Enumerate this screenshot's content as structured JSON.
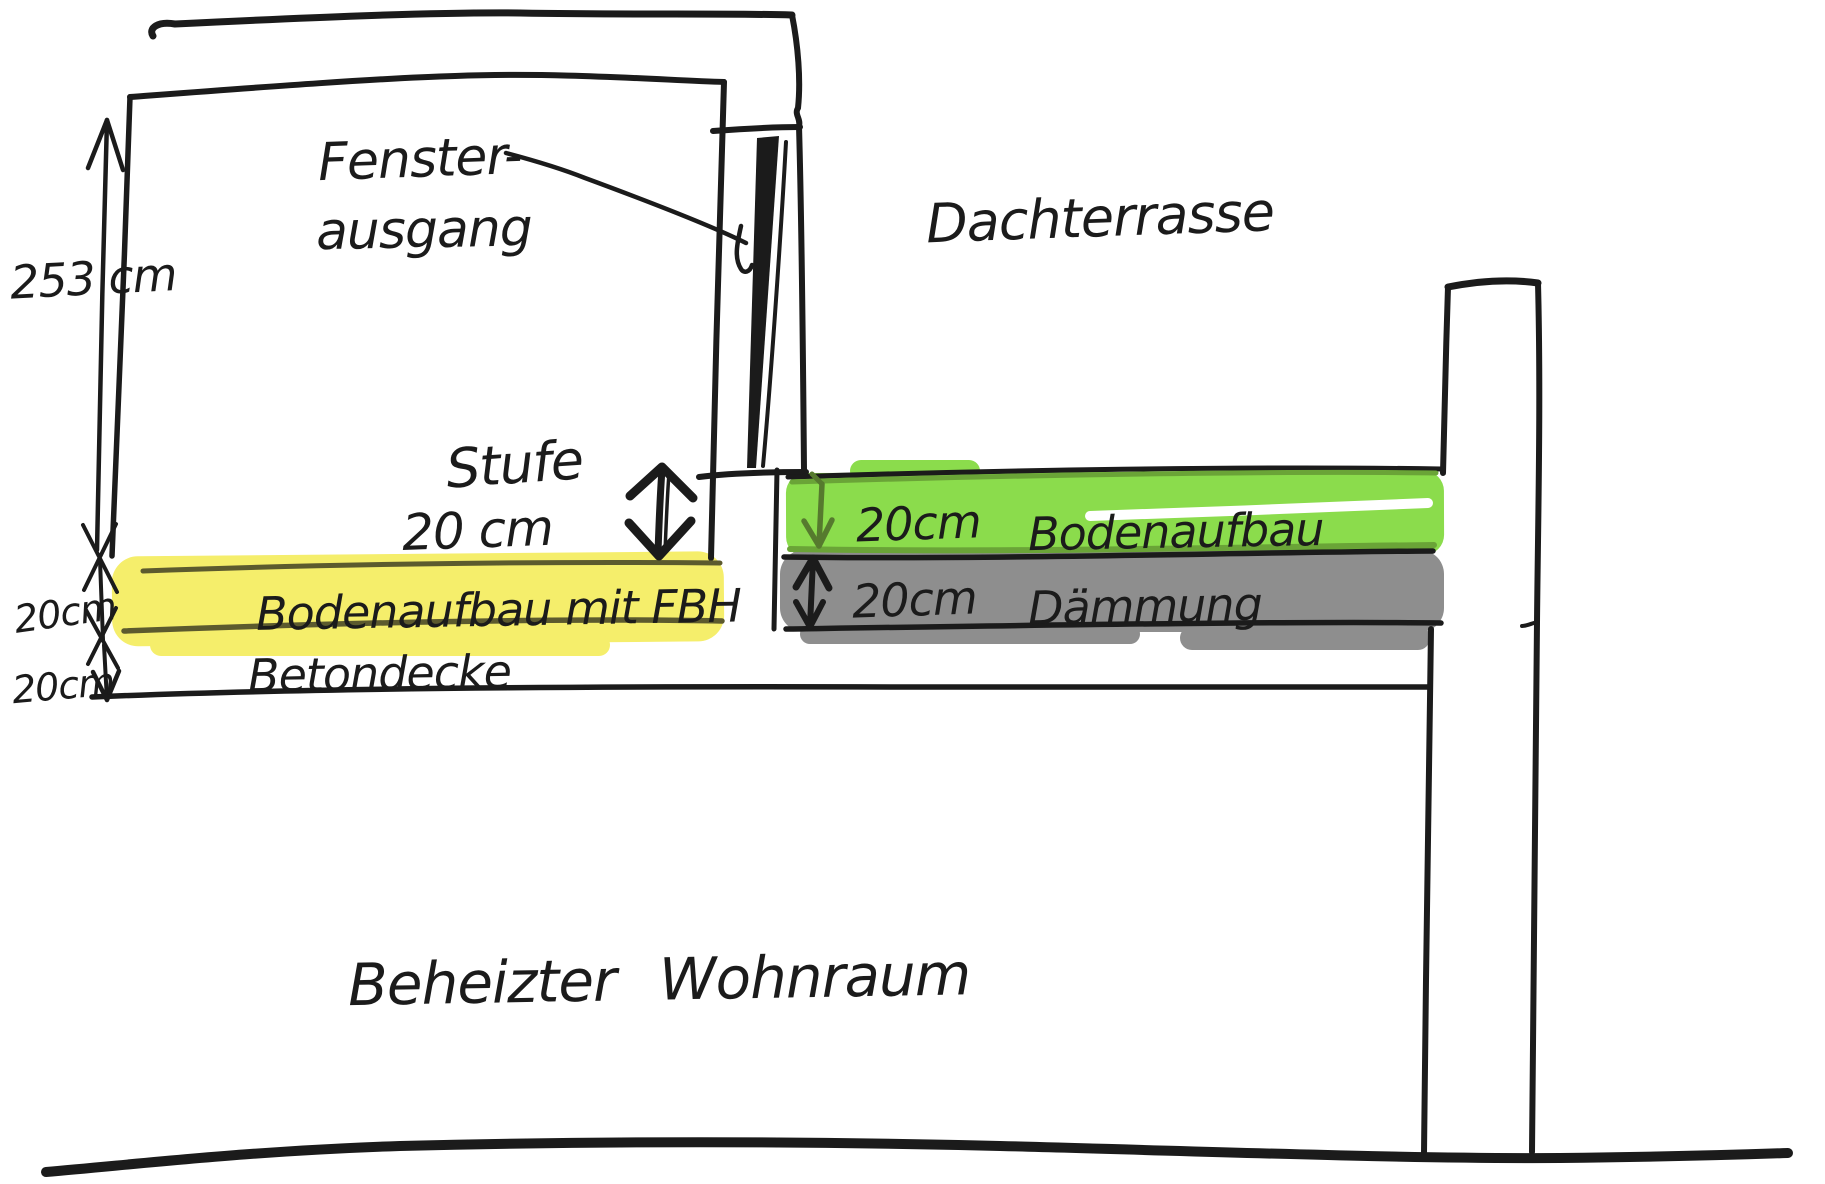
{
  "title": "Hand-drawn building cross-section sketch",
  "colors": {
    "ink": "#1b1b1b",
    "yellow": "#f5ee6b",
    "green": "#8bdc4c",
    "green_edge": "#6aa437",
    "green_text": "#5e7f33",
    "gray": "#8e8e8e"
  },
  "labels": {
    "room_height": "253 cm",
    "window_exit_line1": "Fenster-",
    "window_exit_line2": "ausgang",
    "terrace": "Dachterrasse",
    "step_name": "Stufe",
    "step_size": "20 cm",
    "floor_dim": "20cm",
    "slab_dim": "20cm",
    "yellow_layer": "Bodenaufbau mit FBH",
    "slab": "Betondecke",
    "terrace_floor_dim": "20cm",
    "terrace_floor": "Bodenaufbau",
    "insulation_dim": "20cm",
    "insulation": "Dämmung",
    "heated_room": "Beheizter Wohnraum"
  }
}
